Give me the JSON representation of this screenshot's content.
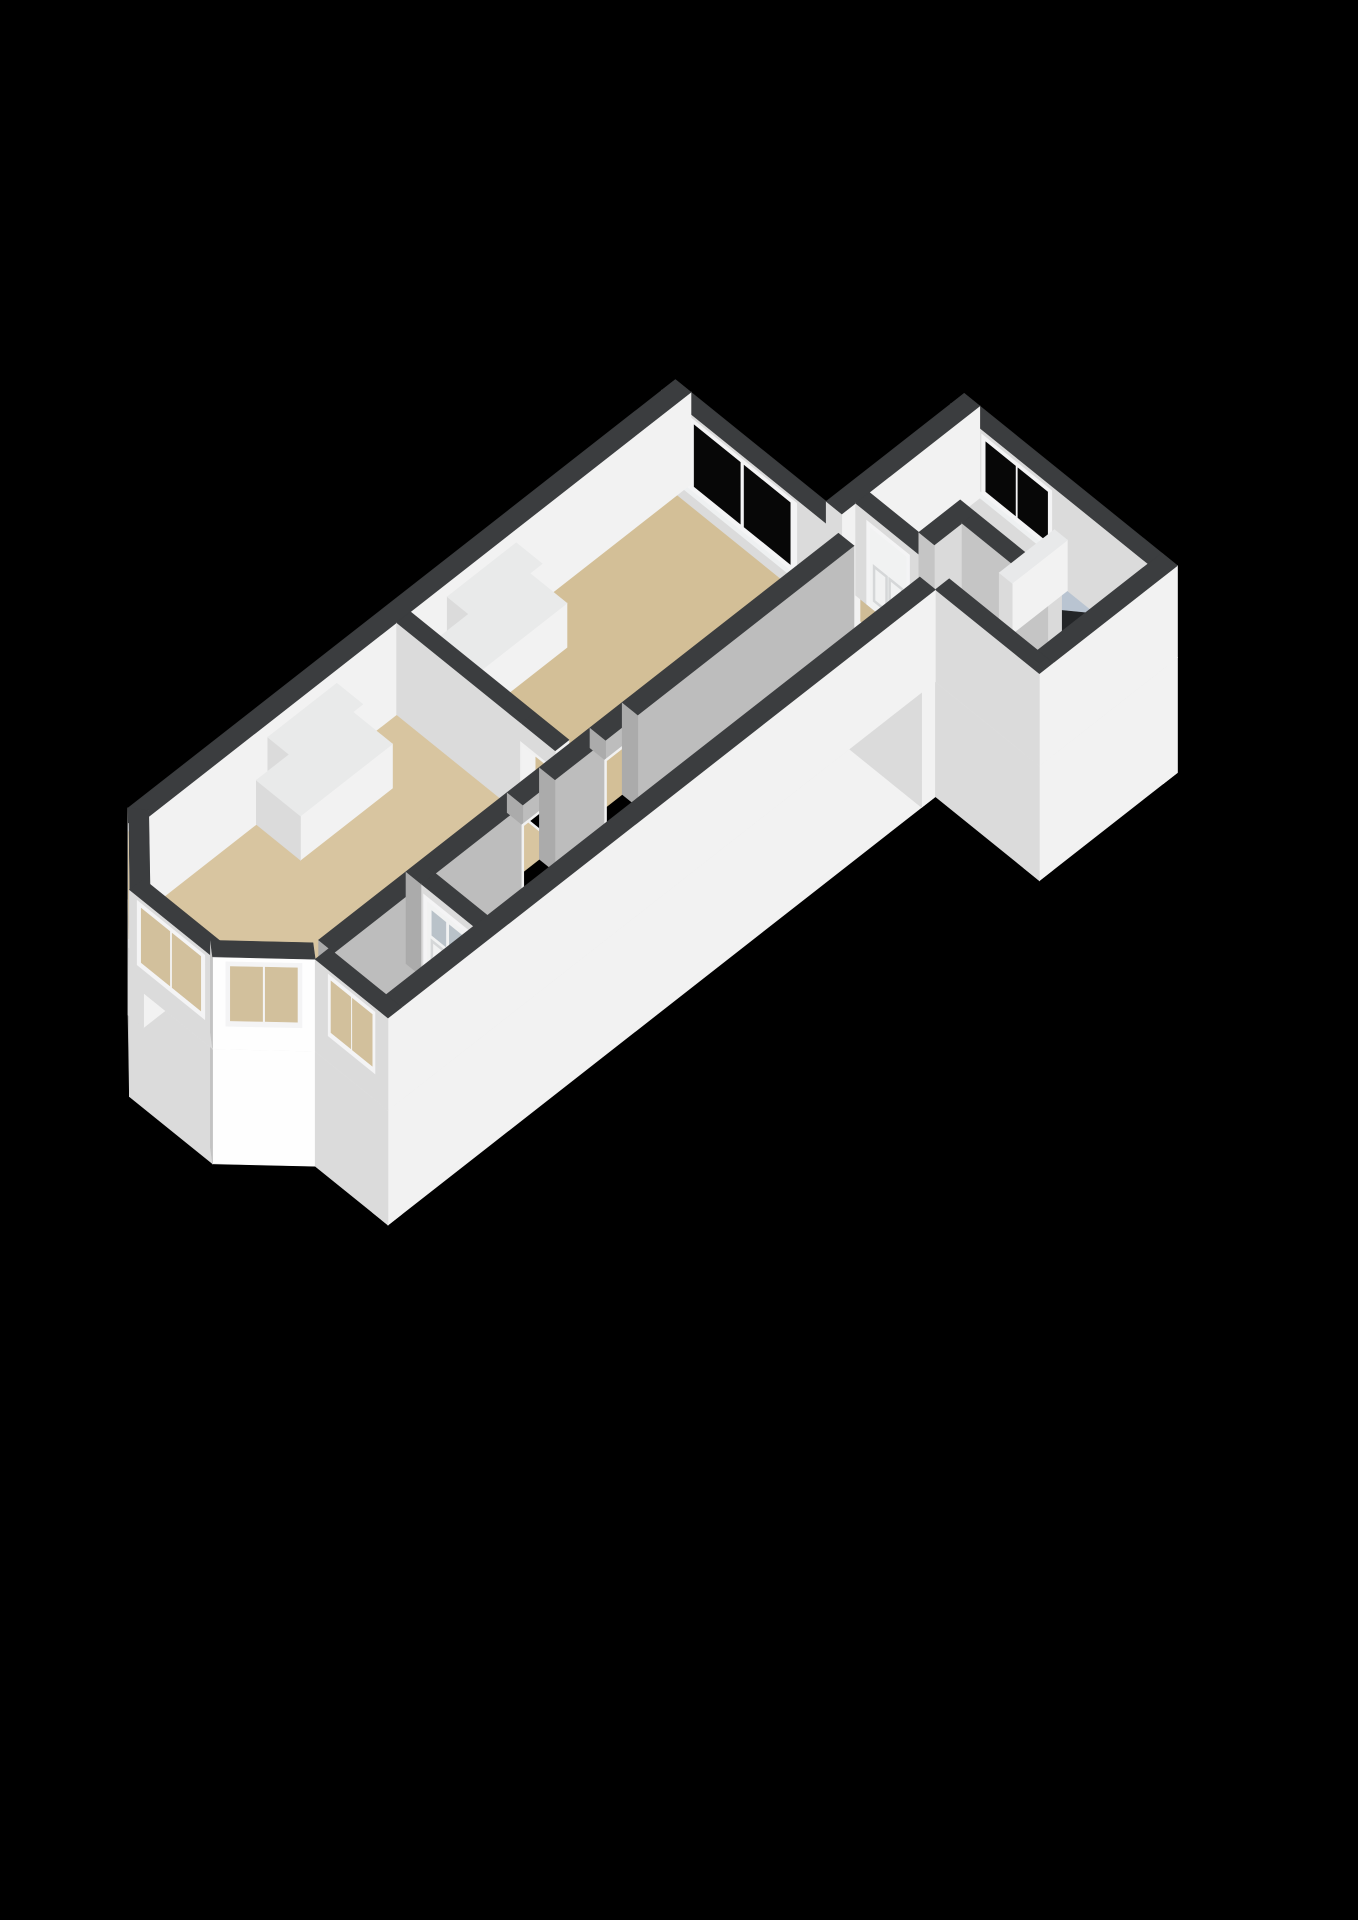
{
  "canvas": {
    "w": 1358,
    "h": 1920,
    "background": "#000000"
  },
  "proj": {
    "ox": 128,
    "oy": 900,
    "ux": 46,
    "uy": -36,
    "vx": 52,
    "vy": 42,
    "zh": 92,
    "camu": -0.55,
    "camv": 0.835
  },
  "palette": {
    "wallTop": "#3b3d3f",
    "chimTop": "#e9eaea",
    "lowTop": "#e8e9ea",
    "skirtTop": "#e8e8e8",
    "faceBase": 243,
    "glassDark": "#070707",
    "glassThru": "#d2c09c",
    "frame": "#f4f4f5",
    "sill": "#eef0f1",
    "doorLeaf": "#f1f2f2",
    "doorGlass": "#b9c2c9",
    "panelLine": "#d5d7d8",
    "jamb": "#f1f1f1",
    "floorTan": "#d8c5a0",
    "floorTanDark": "#d3bf97",
    "floorTanLight": "#dccaa6",
    "floorTanMid": "#d6c39e",
    "floorThresh": "#cfbc96",
    "floorBlue": "#b9c4d1",
    "floorGray": "#b4b7ba",
    "stairHole": "#232527"
  },
  "scene": [
    {
      "t": "prism",
      "name": "skirt-bay-left",
      "poly": [
        [
          0.2,
          0.22
        ],
        [
          -0.9,
          1.22
        ],
        [
          -1.1,
          1.0
        ],
        [
          0,
          0
        ]
      ],
      "z0": -1.25,
      "z1": 0,
      "top": "#e8e8e8"
    },
    {
      "t": "prism",
      "name": "skirt-bay-front",
      "rect": [
        -1.1,
        1.0,
        -0.8,
        2.6
      ],
      "z0": -1.25,
      "z1": 0,
      "top": "#e8e8e8"
    },
    {
      "t": "prism",
      "name": "skirt-bay-right",
      "poly": [
        [
          -0.9,
          2.38
        ],
        [
          0.2,
          3.38
        ],
        [
          0,
          3.6
        ],
        [
          -1.1,
          2.6
        ]
      ],
      "z0": -1.25,
      "z1": 0,
      "top": "#e8e8e8"
    },
    {
      "t": "prism",
      "name": "skirt-front",
      "rect": [
        0,
        3.6,
        0.3,
        5.0
      ],
      "z0": -1.25,
      "z1": 0,
      "top": "#e8e8e8"
    },
    {
      "t": "prism",
      "name": "skirt-left",
      "rect": [
        0,
        0,
        11.9,
        0.3
      ],
      "z0": -1.25,
      "z1": 0,
      "top": "#e8e8e8"
    },
    {
      "t": "prism",
      "name": "skirt-right",
      "rect": [
        0,
        4.7,
        11.9,
        5.0
      ],
      "z0": -1.25,
      "z1": 0,
      "top": "#e8e8e8"
    },
    {
      "t": "prism",
      "name": "skirt-back",
      "rect": [
        11.6,
        0,
        11.9,
        5.0
      ],
      "z0": -1.25,
      "z1": 0,
      "top": "#e8e8e8"
    },
    {
      "t": "prism",
      "name": "skirt-annex-left",
      "rect": [
        11.9,
        2.9,
        14.9,
        3.2
      ],
      "z0": -1.25,
      "z1": 0,
      "top": "#e8e8e8"
    },
    {
      "t": "prism",
      "name": "skirt-annex-back",
      "rect": [
        14.6,
        2.9,
        14.9,
        7.0
      ],
      "z0": -1.25,
      "z1": 0,
      "top": "#e8e8e8"
    },
    {
      "t": "prism",
      "name": "skirt-annex-right",
      "rect": [
        11.9,
        6.7,
        14.9,
        7.0
      ],
      "z0": -1.25,
      "z1": 0,
      "top": "#e8e8e8"
    },
    {
      "t": "prism",
      "name": "skirt-annex-front",
      "rect": [
        11.9,
        5.0,
        12.2,
        7.0
      ],
      "z0": -1.25,
      "z1": 0,
      "top": "#e8e8e8"
    },
    {
      "t": "floor",
      "name": "floor-bedroom",
      "rect": [
        5.8,
        0.3,
        11.6,
        3.4
      ],
      "color": "#d3bf97"
    },
    {
      "t": "floor",
      "name": "floor-living-room",
      "poly": [
        [
          -0.85,
          1.18
        ],
        [
          -0.85,
          2.42
        ],
        [
          0.22,
          3.4
        ],
        [
          5.5,
          3.4
        ],
        [
          5.5,
          0.3
        ],
        [
          0.22,
          0.3
        ]
      ],
      "color": "#d8c5a0"
    },
    {
      "t": "floor",
      "name": "floor-vestibule",
      "rect": [
        0.3,
        3.7,
        2.2,
        4.7
      ],
      "color": "#dccaa6"
    },
    {
      "t": "floor",
      "name": "floor-hallway",
      "rect": [
        2.5,
        3.7,
        11.6,
        4.7
      ],
      "color": "#d6c39e"
    },
    {
      "t": "floor",
      "name": "floor-threshold",
      "rect": [
        11.9,
        3.2,
        12.2,
        5.0
      ],
      "color": "#cfbc96"
    },
    {
      "t": "floor",
      "name": "floor-bathroom",
      "rect": [
        12.2,
        3.2,
        14.6,
        6.7
      ],
      "color": "#b9c4d1"
    },
    {
      "t": "floor",
      "name": "floor-wc",
      "rect": [
        12.5,
        3.2,
        13.4,
        4.15
      ],
      "color": "#b4b7ba"
    },
    {
      "t": "floor",
      "name": "floor-stairwell-opening",
      "poly": [
        [
          13.4,
          5.15
        ],
        [
          14.1,
          5.15
        ],
        [
          14.6,
          5.7
        ],
        [
          14.6,
          6.7
        ],
        [
          13.4,
          6.7
        ]
      ],
      "color": "#232527"
    },
    {
      "t": "prism",
      "name": "wall-back",
      "rect": [
        11.6,
        0,
        11.9,
        3.55
      ],
      "z0": 0,
      "z1": 1
    },
    {
      "t": "window",
      "name": "window-bedroom",
      "p1": [
        11.6,
        0.5
      ],
      "p2": [
        11.6,
        2.6
      ],
      "z0": 0.18,
      "z1": 0.96,
      "glass": "glassDark",
      "mullions": 1,
      "sill": true
    },
    {
      "t": "prism",
      "name": "lintel-annex-passage",
      "rect": [
        11.6,
        3.55,
        11.9,
        4.55
      ],
      "z0": 0.78,
      "z1": 1
    },
    {
      "t": "jamb",
      "name": "doorframe-annex-passage",
      "p1": [
        11.6,
        3.55
      ],
      "p2": [
        11.6,
        4.55
      ],
      "z0": 0,
      "z1": 0.78
    },
    {
      "t": "prism",
      "name": "wall-back-corner",
      "rect": [
        11.6,
        4.55,
        11.9,
        5.0
      ],
      "z0": 0,
      "z1": 1
    },
    {
      "t": "prism",
      "name": "wall-annex-back",
      "rect": [
        14.6,
        2.9,
        14.9,
        7.0
      ],
      "z0": 0,
      "z1": 1
    },
    {
      "t": "window",
      "name": "window-bathroom",
      "p1": [
        14.6,
        3.5
      ],
      "p2": [
        14.6,
        4.85
      ],
      "z0": 0.3,
      "z1": 0.95,
      "glass": "glassDark",
      "mullions": 1,
      "sill": true
    },
    {
      "t": "prism",
      "name": "wall-annex-left",
      "rect": [
        11.9,
        2.9,
        14.9,
        3.2
      ],
      "z0": 0,
      "z1": 1
    },
    {
      "t": "prism",
      "name": "wall-wc-front",
      "rect": [
        12.2,
        3.2,
        12.5,
        4.45
      ],
      "z0": 0,
      "z1": 1
    },
    {
      "t": "door",
      "name": "door-wc",
      "p1": [
        12.2,
        3.45
      ],
      "p2": [
        12.2,
        4.2
      ],
      "h": 0.86,
      "glassTop": false
    },
    {
      "t": "prism",
      "name": "wall-wc-side",
      "rect": [
        12.5,
        4.15,
        13.4,
        4.45
      ],
      "z0": 0,
      "z1": 1,
      "dim": 0.9
    },
    {
      "t": "prism",
      "name": "wall-stairwell",
      "rect": [
        13.1,
        4.45,
        13.4,
        6.1
      ],
      "z0": 0,
      "z1": 1,
      "dim": 0.9
    },
    {
      "t": "prism",
      "name": "wall-stair-balustrade",
      "rect": [
        13.4,
        4.9,
        14.6,
        5.15
      ],
      "z0": 0,
      "z1": 0.55,
      "top": "#e8e9ea"
    },
    {
      "t": "prism",
      "name": "wall-annex-right",
      "rect": [
        11.9,
        6.7,
        14.9,
        7.0
      ],
      "z0": 0,
      "z1": 1
    },
    {
      "t": "prism",
      "name": "wall-annex-front",
      "rect": [
        11.9,
        5.0,
        12.2,
        7.0
      ],
      "z0": 0,
      "z1": 1
    },
    {
      "t": "prism",
      "name": "wall-left",
      "rect": [
        0,
        0,
        11.9,
        0.3
      ],
      "z0": 0,
      "z1": 1
    },
    {
      "t": "prism",
      "name": "chimney-bedroom-upper",
      "rect": [
        6.6,
        0.3,
        8.1,
        0.8
      ],
      "z0": 0,
      "z1": 0.85,
      "top": "#e9eaea"
    },
    {
      "t": "prism",
      "name": "chimney-bedroom-lower",
      "rect": [
        6.4,
        0.3,
        8.3,
        1.1
      ],
      "z0": 0,
      "z1": 0.48,
      "top": "#e9eaea"
    },
    {
      "t": "prism",
      "name": "wall-rooms-divider",
      "rect": [
        5.5,
        0.3,
        5.8,
        2.7
      ],
      "z0": 0,
      "z1": 1
    },
    {
      "t": "prism",
      "name": "lintel-rooms-doorway",
      "rect": [
        5.5,
        2.7,
        5.8,
        3.35
      ],
      "z0": 0.78,
      "z1": 1
    },
    {
      "t": "jamb",
      "name": "doorframe-rooms-doorway",
      "p1": [
        5.5,
        2.7
      ],
      "p2": [
        5.5,
        3.35
      ],
      "z0": 0,
      "z1": 0.78
    },
    {
      "t": "prism",
      "name": "chimney-living-upper",
      "rect": [
        2.7,
        0.3,
        4.2,
        0.8
      ],
      "z0": 0,
      "z1": 0.85,
      "top": "#e9eaea"
    },
    {
      "t": "prism",
      "name": "chimney-living-lower",
      "rect": [
        2.45,
        0.3,
        4.45,
        1.15
      ],
      "z0": 0,
      "z1": 0.48,
      "top": "#e9eaea"
    },
    {
      "t": "prism",
      "name": "wall-hall-a",
      "rect": [
        0.3,
        3.4,
        2.2,
        3.7
      ],
      "z0": 0,
      "z1": 1,
      "dim": 0.78
    },
    {
      "t": "prism",
      "name": "wall-hall-b",
      "rect": [
        2.2,
        3.4,
        4.4,
        3.7
      ],
      "z0": 0,
      "z1": 1,
      "dim": 0.78
    },
    {
      "t": "prism",
      "name": "lintel-living-door",
      "rect": [
        4.4,
        3.4,
        5.1,
        3.7
      ],
      "z0": 0.78,
      "z1": 1,
      "dim": 0.78
    },
    {
      "t": "jamb",
      "name": "doorframe-living",
      "p1": [
        4.4,
        3.7
      ],
      "p2": [
        5.1,
        3.7
      ],
      "z0": 0,
      "z1": 0.78
    },
    {
      "t": "prism",
      "name": "wall-hall-c",
      "rect": [
        5.1,
        3.4,
        6.2,
        3.7
      ],
      "z0": 0,
      "z1": 1,
      "dim": 0.78
    },
    {
      "t": "prism",
      "name": "lintel-bedroom-door",
      "rect": [
        6.2,
        3.4,
        6.9,
        3.7
      ],
      "z0": 0.78,
      "z1": 1,
      "dim": 0.78
    },
    {
      "t": "jamb",
      "name": "doorframe-bedroom",
      "p1": [
        6.2,
        3.7
      ],
      "p2": [
        6.9,
        3.7
      ],
      "z0": 0,
      "z1": 0.78
    },
    {
      "t": "prism",
      "name": "wall-hall-d",
      "rect": [
        6.9,
        3.4,
        11.6,
        3.7
      ],
      "z0": 0,
      "z1": 1,
      "dim": 0.78
    },
    {
      "t": "prism",
      "name": "wall-entrance",
      "rect": [
        2.2,
        3.7,
        2.5,
        4.7
      ],
      "z0": 0,
      "z1": 1
    },
    {
      "t": "door",
      "name": "door-entrance",
      "p1": [
        2.2,
        3.78
      ],
      "p2": [
        2.2,
        4.62
      ],
      "h": 0.86,
      "glassTop": true
    },
    {
      "t": "prism",
      "name": "wall-right",
      "rect": [
        0,
        4.7,
        11.9,
        5.0
      ],
      "z0": 0,
      "z1": 1
    },
    {
      "t": "prism",
      "name": "wall-bay-left",
      "poly": [
        [
          0.2,
          0.22
        ],
        [
          -0.9,
          1.22
        ],
        [
          -1.1,
          1.0
        ],
        [
          0,
          0
        ]
      ],
      "z0": 0,
      "z1": 1
    },
    {
      "t": "window",
      "name": "window-bay-left",
      "p1": [
        -0.14,
        0.13
      ],
      "p2": [
        -0.96,
        0.87
      ],
      "z0": 0.25,
      "z1": 0.95,
      "glass": "glassThru",
      "mullions": 1,
      "sill": false
    },
    {
      "t": "prism",
      "name": "wall-bay-front",
      "rect": [
        -1.1,
        1.0,
        -0.8,
        2.6
      ],
      "z0": 0,
      "z1": 1
    },
    {
      "t": "window",
      "name": "window-bay-front",
      "p1": [
        -1.1,
        1.15
      ],
      "p2": [
        -1.1,
        2.45
      ],
      "z0": 0.25,
      "z1": 0.95,
      "glass": "glassThru",
      "mullions": 1,
      "sill": false
    },
    {
      "t": "prism",
      "name": "wall-bay-right",
      "poly": [
        [
          -0.9,
          2.38
        ],
        [
          0.2,
          3.38
        ],
        [
          0,
          3.6
        ],
        [
          -1.1,
          2.6
        ]
      ],
      "z0": 0,
      "z1": 1
    },
    {
      "t": "window",
      "name": "window-bay-right",
      "p1": [
        -0.96,
        2.73
      ],
      "p2": [
        -0.14,
        3.47
      ],
      "z0": 0.25,
      "z1": 0.95,
      "glass": "glassThru",
      "mullions": 1,
      "sill": false
    },
    {
      "t": "prism",
      "name": "wall-front",
      "rect": [
        0,
        3.6,
        0.3,
        5.0
      ],
      "z0": 0,
      "z1": 1
    },
    {
      "t": "window",
      "name": "window-vestibule",
      "p1": [
        0,
        3.85
      ],
      "p2": [
        0,
        4.75
      ],
      "z0": 0.28,
      "z1": 0.95,
      "glass": "glassThru",
      "mullions": 1,
      "sill": false
    }
  ]
}
